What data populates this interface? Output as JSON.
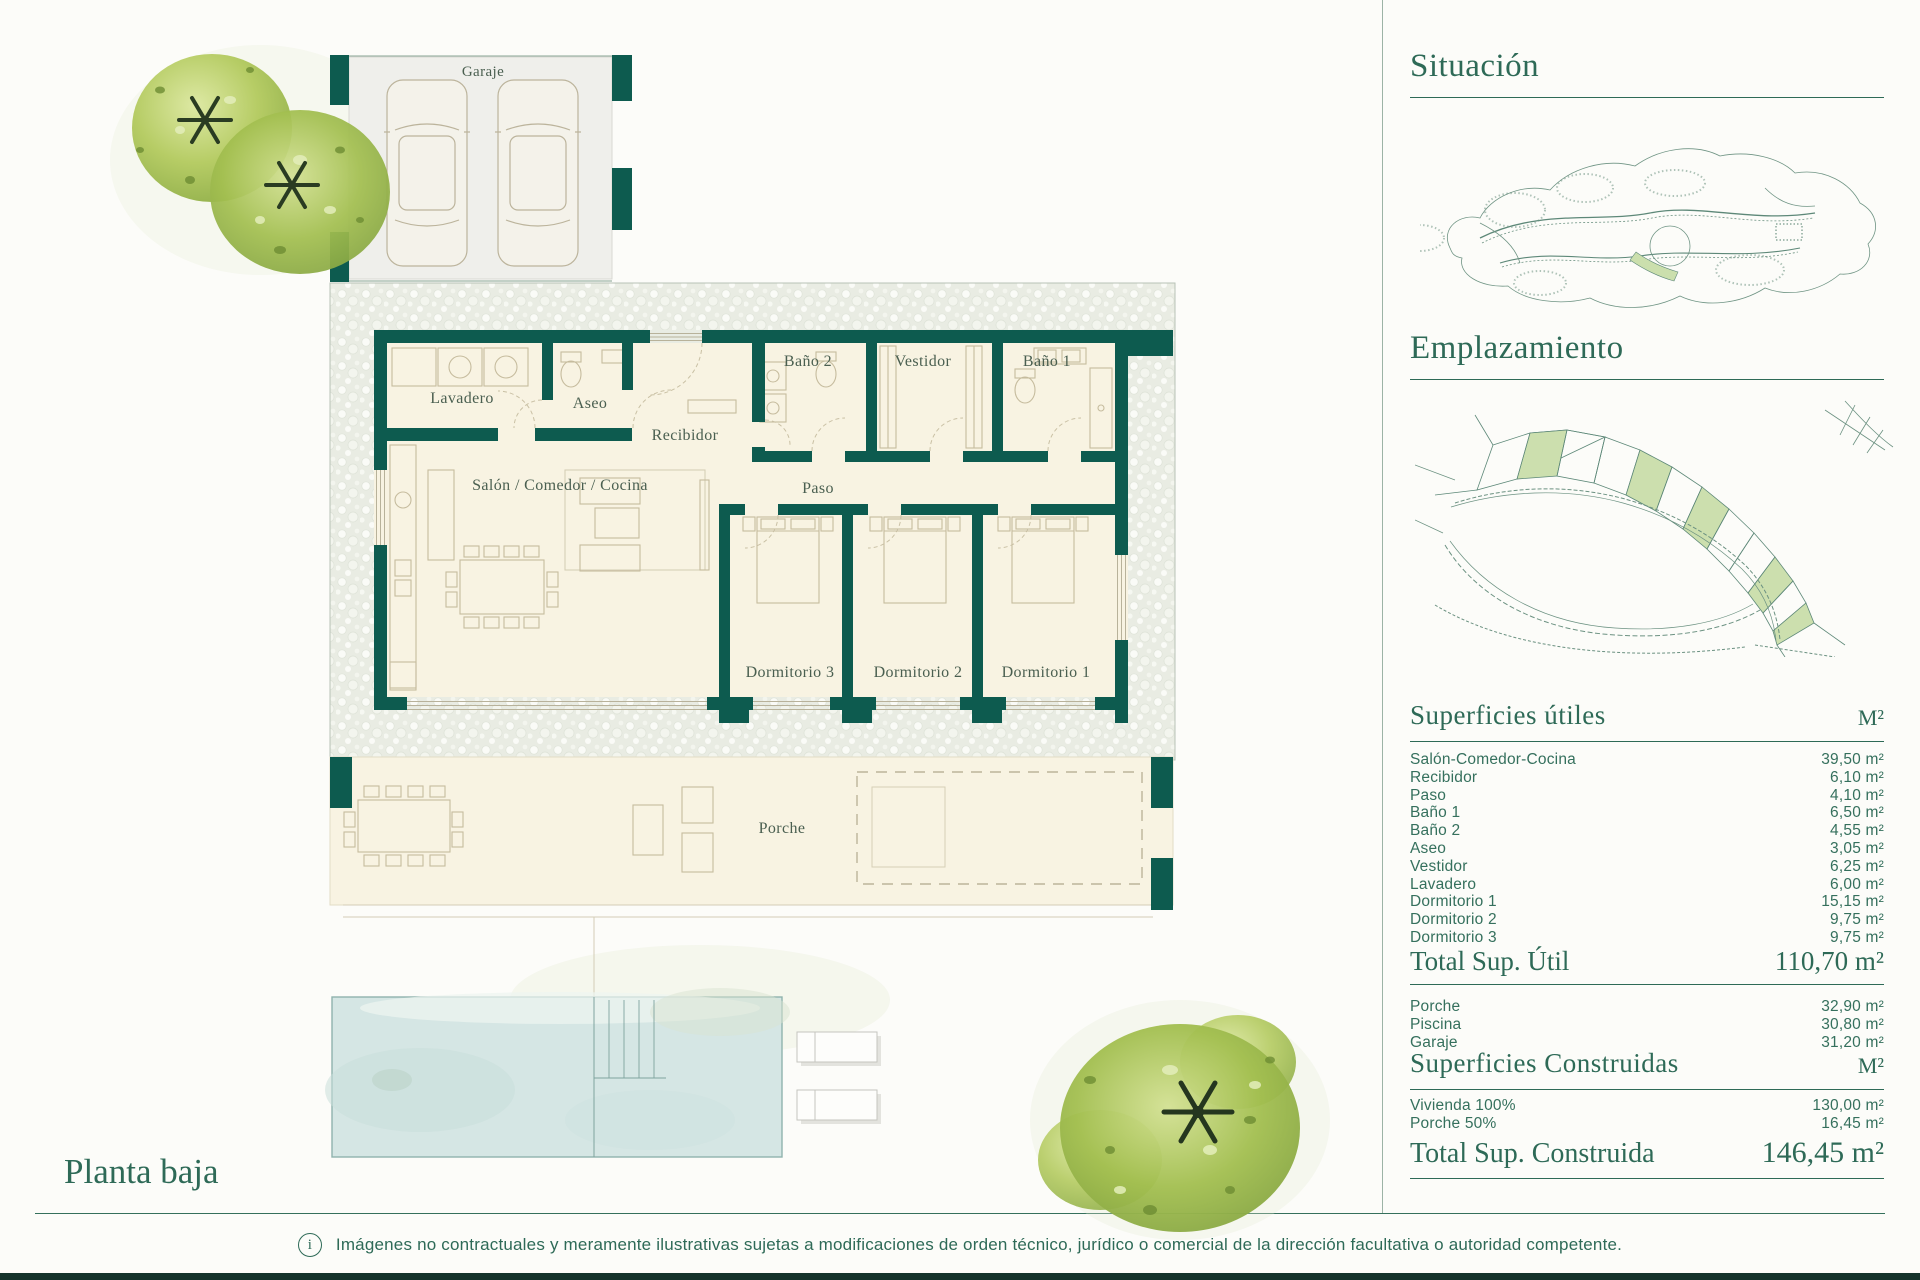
{
  "plan": {
    "title": "Planta baja",
    "rooms": {
      "garaje": "Garaje",
      "lavadero": "Lavadero",
      "aseo": "Aseo",
      "recibidor": "Recibidor",
      "bano2": "Baño 2",
      "vestidor": "Vestidor",
      "bano1": "Baño 1",
      "salon": "Salón / Comedor / Cocina",
      "paso": "Paso",
      "dormitorio3": "Dormitorio 3",
      "dormitorio2": "Dormitorio 2",
      "dormitorio1": "Dormitorio 1",
      "porche": "Porche"
    }
  },
  "sidebar": {
    "situacion_title": "Situación",
    "emplazamiento_title": "Emplazamiento",
    "superficies_utiles": {
      "title": "Superficies útiles",
      "unit": "M²",
      "rows": [
        {
          "label": "Salón-Comedor-Cocina",
          "value": "39,50 m²"
        },
        {
          "label": "Recibidor",
          "value": "6,10 m²"
        },
        {
          "label": "Paso",
          "value": "4,10 m²"
        },
        {
          "label": "Baño 1",
          "value": "6,50 m²"
        },
        {
          "label": "Baño 2",
          "value": "4,55 m²"
        },
        {
          "label": "Aseo",
          "value": "3,05 m²"
        },
        {
          "label": "Vestidor",
          "value": "6,25 m²"
        },
        {
          "label": "Lavadero",
          "value": "6,00 m²"
        },
        {
          "label": "Dormitorio 1",
          "value": "15,15 m²"
        },
        {
          "label": "Dormitorio 2",
          "value": "9,75 m²"
        },
        {
          "label": "Dormitorio 3",
          "value": "9,75 m²"
        }
      ]
    },
    "total_util": {
      "label": "Total Sup. Útil",
      "value": "110,70 m²"
    },
    "exterior_rows": [
      {
        "label": "Porche",
        "value": "32,90 m²"
      },
      {
        "label": "Piscina",
        "value": "30,80 m²"
      },
      {
        "label": "Garaje",
        "value": "31,20 m²"
      }
    ],
    "superficies_construidas": {
      "title": "Superficies Construidas",
      "unit": "M²",
      "rows": [
        {
          "label": "Vivienda 100%",
          "value": "130,00 m²"
        },
        {
          "label": "Porche 50%",
          "value": "16,45 m²"
        }
      ]
    },
    "total_construida": {
      "label": "Total Sup. Construida",
      "value": "146,45 m²"
    }
  },
  "footer": {
    "info_glyph": "i",
    "disclaimer": "Imágenes no contractuales y meramente ilustrativas sujetas a modificaciones de orden técnico, jurídico o comercial de la dirección facultativa o autoridad competente."
  },
  "colors": {
    "wall_teal": "#0d5b4f",
    "heading_green": "#2e6a57",
    "room_cream": "#f8f3e2",
    "pool_blue": "#d5e6e4",
    "parcel_green": "#ccdfae",
    "pebble_bg": "#e9ece3"
  }
}
